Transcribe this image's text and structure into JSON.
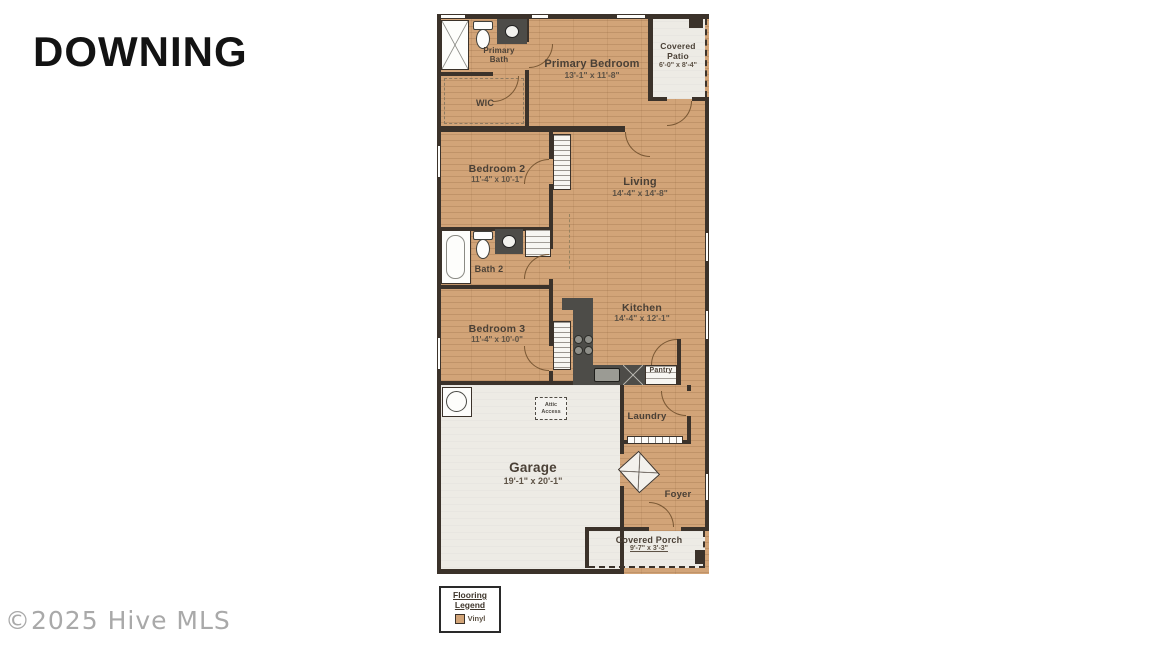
{
  "page": {
    "title": "DOWNING",
    "watermark": "©2025 Hive MLS"
  },
  "plan": {
    "rooms": {
      "primary_bedroom": {
        "name": "Primary Bedroom",
        "dims": "13'-1\" x 11'-8\""
      },
      "covered_patio": {
        "name": "Covered Patio",
        "dims": "6'-0\" x 8'-4\""
      },
      "primary_bath": {
        "name": "Primary Bath"
      },
      "wic": {
        "name": "WIC"
      },
      "bedroom2": {
        "name": "Bedroom 2",
        "dims": "11'-4\" x 10'-1\""
      },
      "living": {
        "name": "Living",
        "dims": "14'-4\" x 14'-8\""
      },
      "bath2": {
        "name": "Bath 2"
      },
      "bedroom3": {
        "name": "Bedroom 3",
        "dims": "11'-4\" x 10'-0\""
      },
      "kitchen": {
        "name": "Kitchen",
        "dims": "14'-4\" x 12'-1\""
      },
      "pantry": {
        "name": "Pantry"
      },
      "laundry": {
        "name": "Laundry"
      },
      "garage": {
        "name": "Garage",
        "dims": "19'-1\" x 20'-1\""
      },
      "foyer": {
        "name": "Foyer"
      },
      "covered_porch": {
        "name": "Covered Porch",
        "dims": "9'-7\" x 3'-3\""
      },
      "attic_access": {
        "name": "Attic Access"
      }
    },
    "legend": {
      "title": "Flooring Legend",
      "items": [
        {
          "label": "Vinyl",
          "swatch": "#d2a478"
        }
      ]
    },
    "colors": {
      "wood": "#d2a478",
      "wall": "#3b322a",
      "exterior_floor": "#edebe5",
      "counter": "#4d4c48"
    }
  }
}
